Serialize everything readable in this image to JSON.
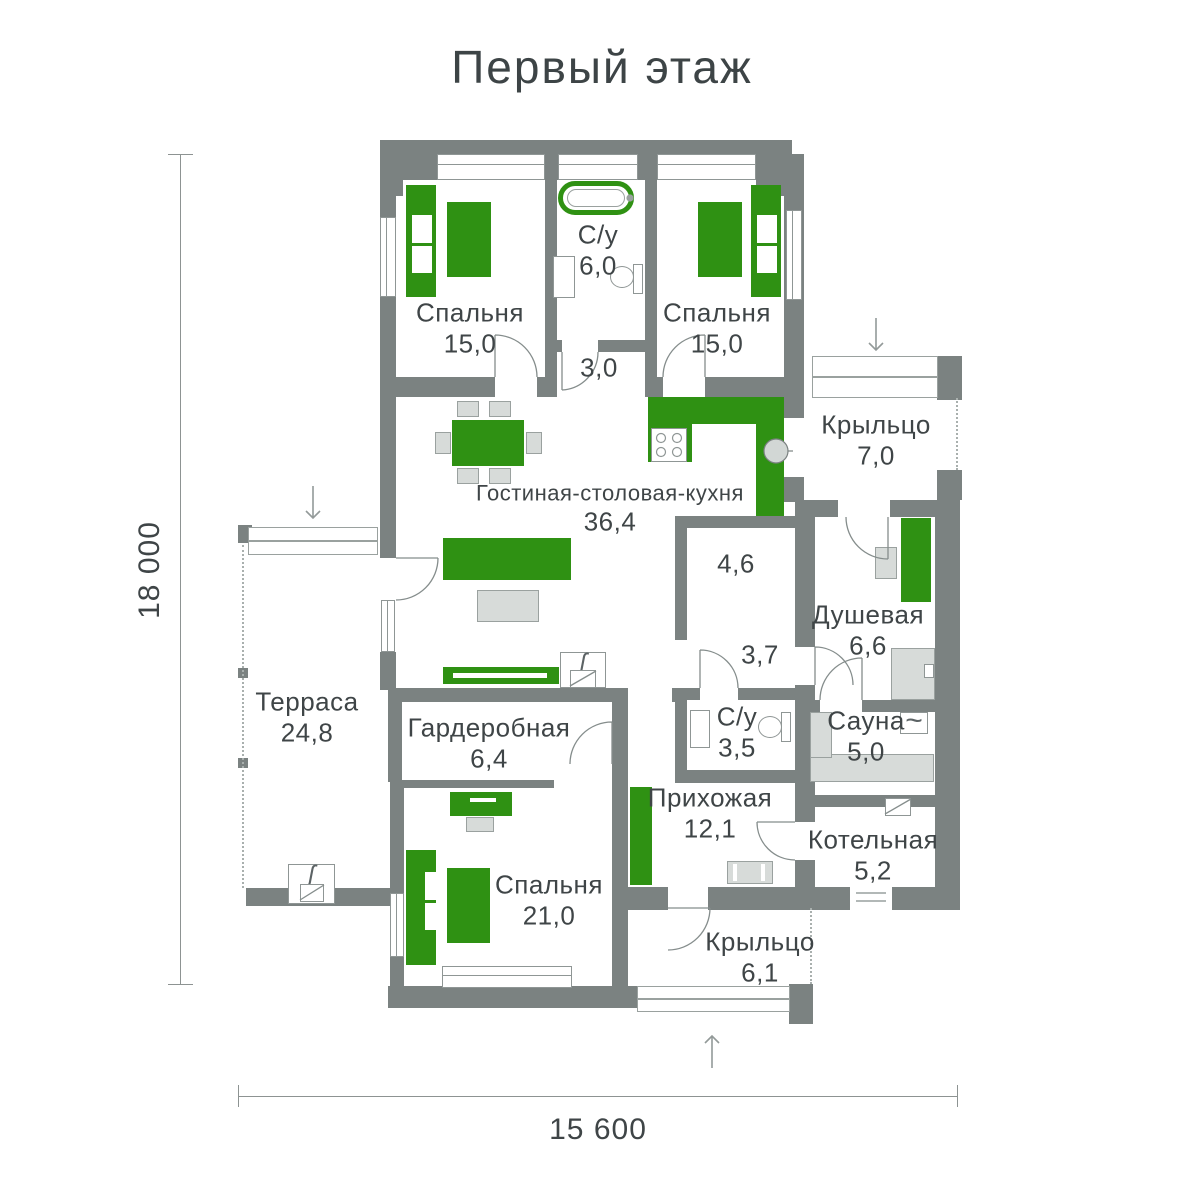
{
  "title": "Первый этаж",
  "dimensions": {
    "height": "18 000",
    "width": "15 600"
  },
  "rooms": {
    "bedroom_left": {
      "name": "Спальня",
      "area": "15,0"
    },
    "bathroom_top": {
      "name": "С/у",
      "area": "6,0"
    },
    "hall_top": {
      "area": "3,0"
    },
    "bedroom_right": {
      "name": "Спальня",
      "area": "15,0"
    },
    "porch_top": {
      "name": "Крыльцо",
      "area": "7,0"
    },
    "living": {
      "name": "Гостиная-столовая-кухня",
      "area": "36,4"
    },
    "pantry": {
      "area": "4,6"
    },
    "shower": {
      "name": "Душевая",
      "area": "6,6"
    },
    "terrace": {
      "name": "Терраса",
      "area": "24,8"
    },
    "hall_mid": {
      "area": "3,7"
    },
    "bathroom_small": {
      "name": "С/у",
      "area": "3,5"
    },
    "sauna": {
      "name": "Сауна",
      "area": "5,0"
    },
    "wardrobe": {
      "name": "Гардеробная",
      "area": "6,4"
    },
    "hallway": {
      "name": "Прихожая",
      "area": "12,1"
    },
    "boiler": {
      "name": "Котельная",
      "area": "5,2"
    },
    "bedroom_big": {
      "name": "Спальня",
      "area": "21,0"
    },
    "porch_bottom": {
      "name": "Крыльцо",
      "area": "6,1"
    }
  },
  "icons": {
    "flame": "ʃ",
    "wave": "~"
  },
  "colors": {
    "wall": "#7b8281",
    "accent_green": "#2f9113",
    "furniture_gray": "#d7dbd9",
    "text": "#41474a"
  }
}
